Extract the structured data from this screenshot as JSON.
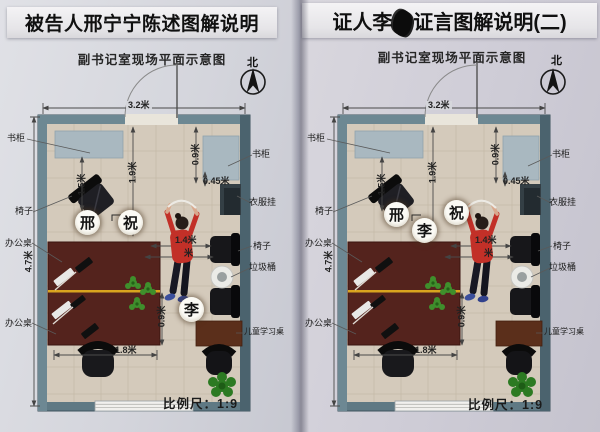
{
  "panels": [
    {
      "title": "被告人邢宁宁陈述图解说明",
      "subtitle": "副书记室现场平面示意图",
      "compass_label": "北",
      "scale_label": "比例尺：1:9",
      "persons": {
        "xing": "邢",
        "zhu": "祝",
        "li": "李"
      }
    },
    {
      "title_prefix": "证人李",
      "title_suffix": "证言图解说明(二)",
      "subtitle": "副书记室现场平面示意图",
      "compass_label": "北",
      "scale_label": "比例尺：1:9",
      "persons": {
        "xing": "邢",
        "zhu": "祝",
        "li": "李"
      }
    }
  ],
  "furniture_labels": {
    "bookcase_left": "书柜",
    "bookcase_right": "书柜",
    "clothes_rack": "衣服挂",
    "chair_left": "椅子",
    "chair_right": "椅子",
    "office_desk_upper": "办公桌",
    "office_desk_lower": "办公桌",
    "trash_bin": "垃圾桶",
    "kids_study_desk": "儿童学习桌"
  },
  "dimensions": {
    "room_width_top": "3.2米",
    "left_area_depth": "1.9米",
    "bookcase_right_depth": "0.9米",
    "bookcase_right_gap": "0.45米",
    "chair_area": "1.5米",
    "person_to_wall": "1.4米",
    "hidden_dim_suffix": "米",
    "room_height_left": "4.7米",
    "desk_lower_depth": "0.9米",
    "desk_width": "1.8米"
  },
  "colors": {
    "paper": "#d3d4da",
    "wall": "#617b87",
    "floor": "#d4cabb",
    "desk": "#54231d",
    "desk_divider_line": "#d9a41e",
    "bookcase": "#a9b8c0",
    "kids_desk": "#5b2f1b",
    "plant": "#2c7a22",
    "person_shirt": "#c23028",
    "title_text": "#111111"
  }
}
